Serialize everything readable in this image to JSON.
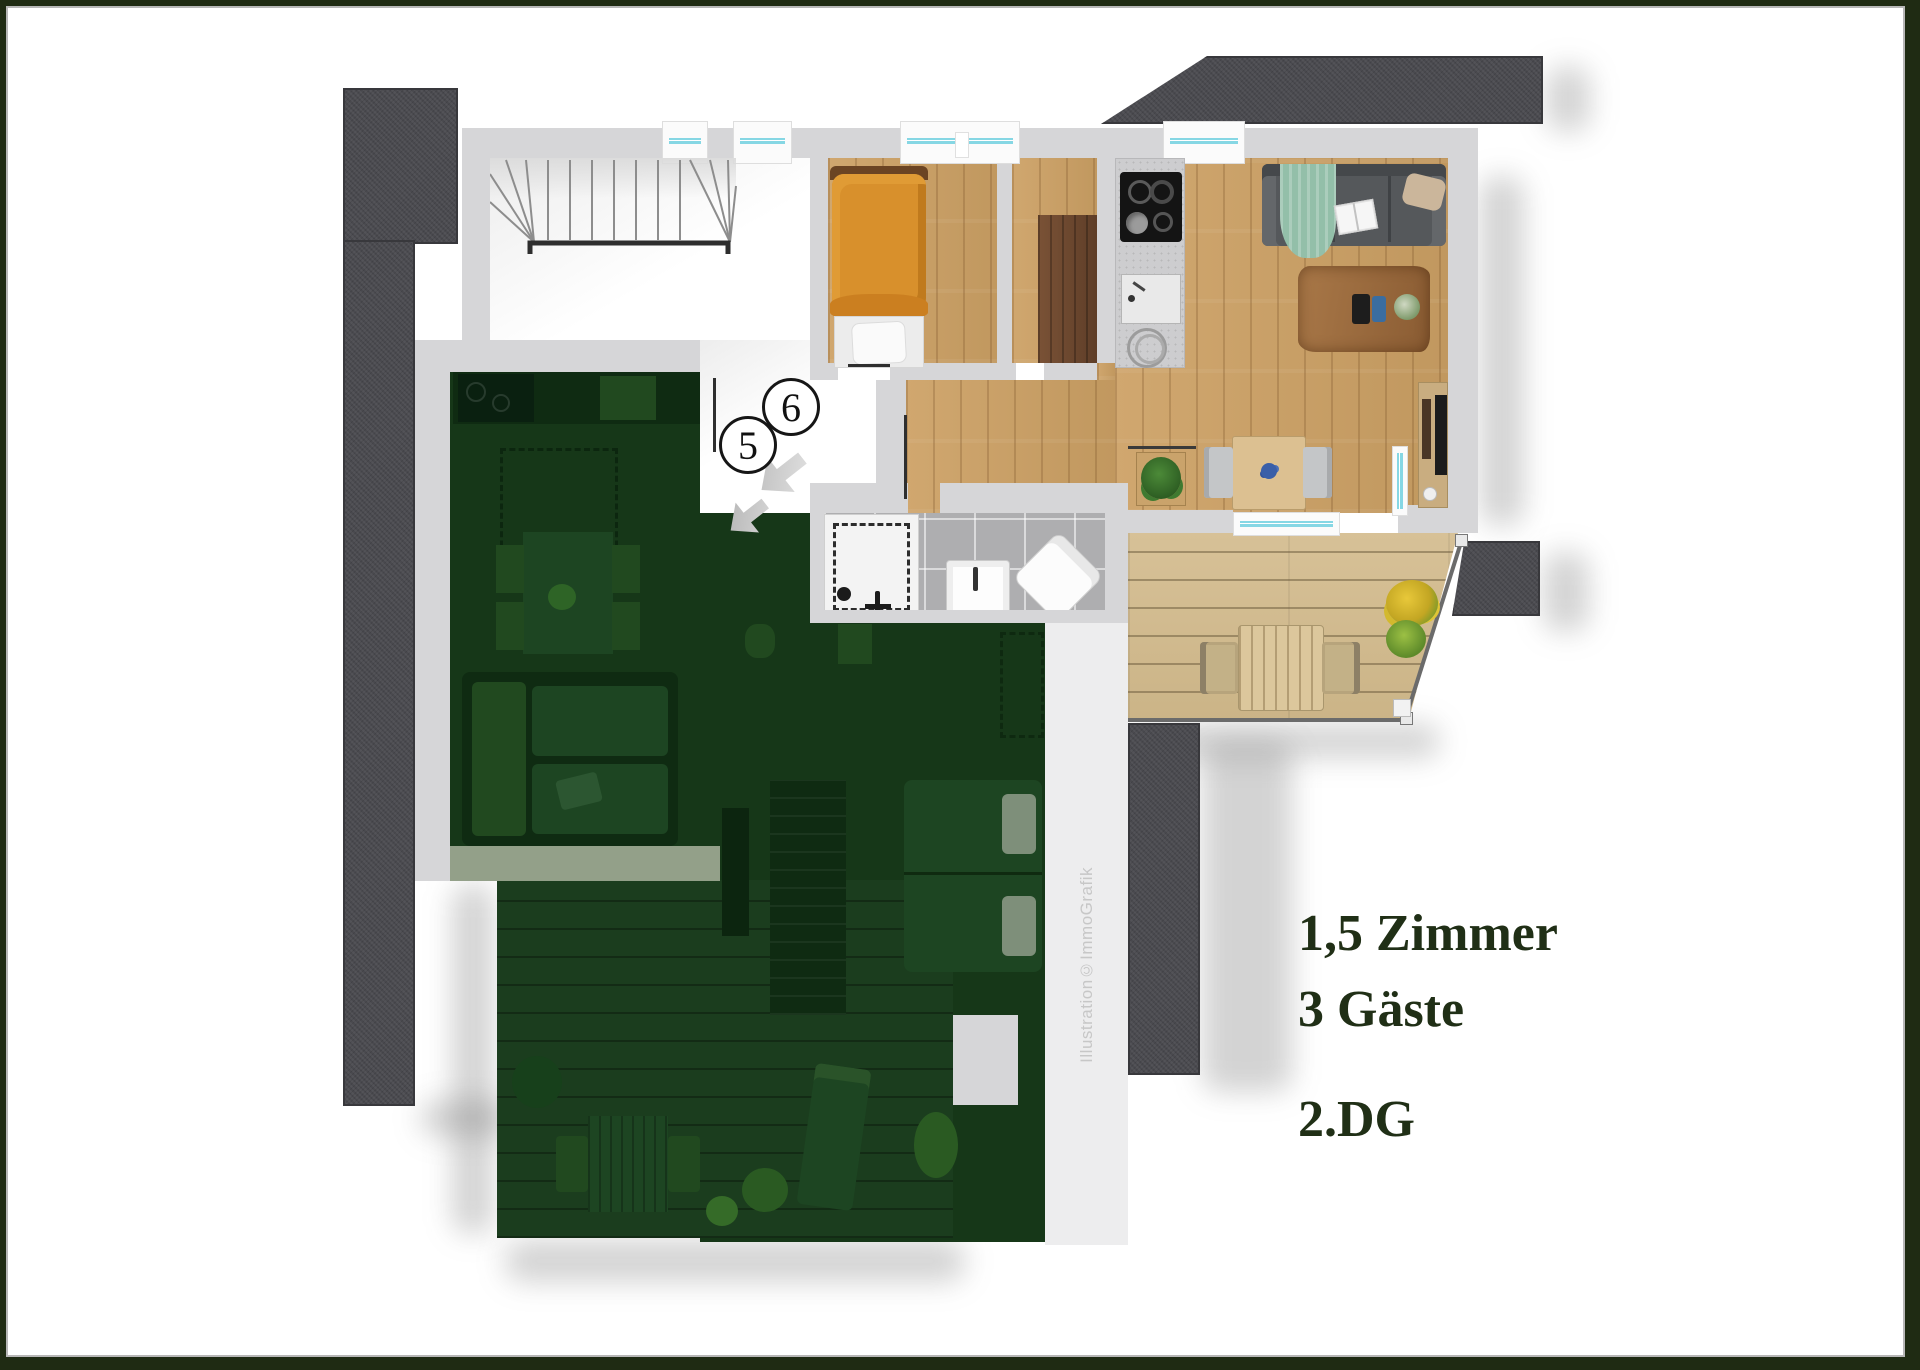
{
  "title_block": {
    "rooms": "1,5 Zimmer",
    "guests": "3 Gäste",
    "floor": "2.DG"
  },
  "markers": {
    "unit5": "5",
    "unit6": "6"
  },
  "watermark": "Illustration©ImmoGrafik",
  "palette": {
    "frame_green": "#1f2b13",
    "label_green": "#202f16",
    "wall_gray": "#d6d6d8",
    "roof_dark_gray": "#4a4a4f",
    "wood_floor": "#cda46e",
    "terrace_wood": "#d2bd92",
    "green_overlay": "#163718",
    "window_glass_cyan": "#86d7e4",
    "bed_orange": "#d8902c",
    "sofa_gray": "#55585b"
  }
}
